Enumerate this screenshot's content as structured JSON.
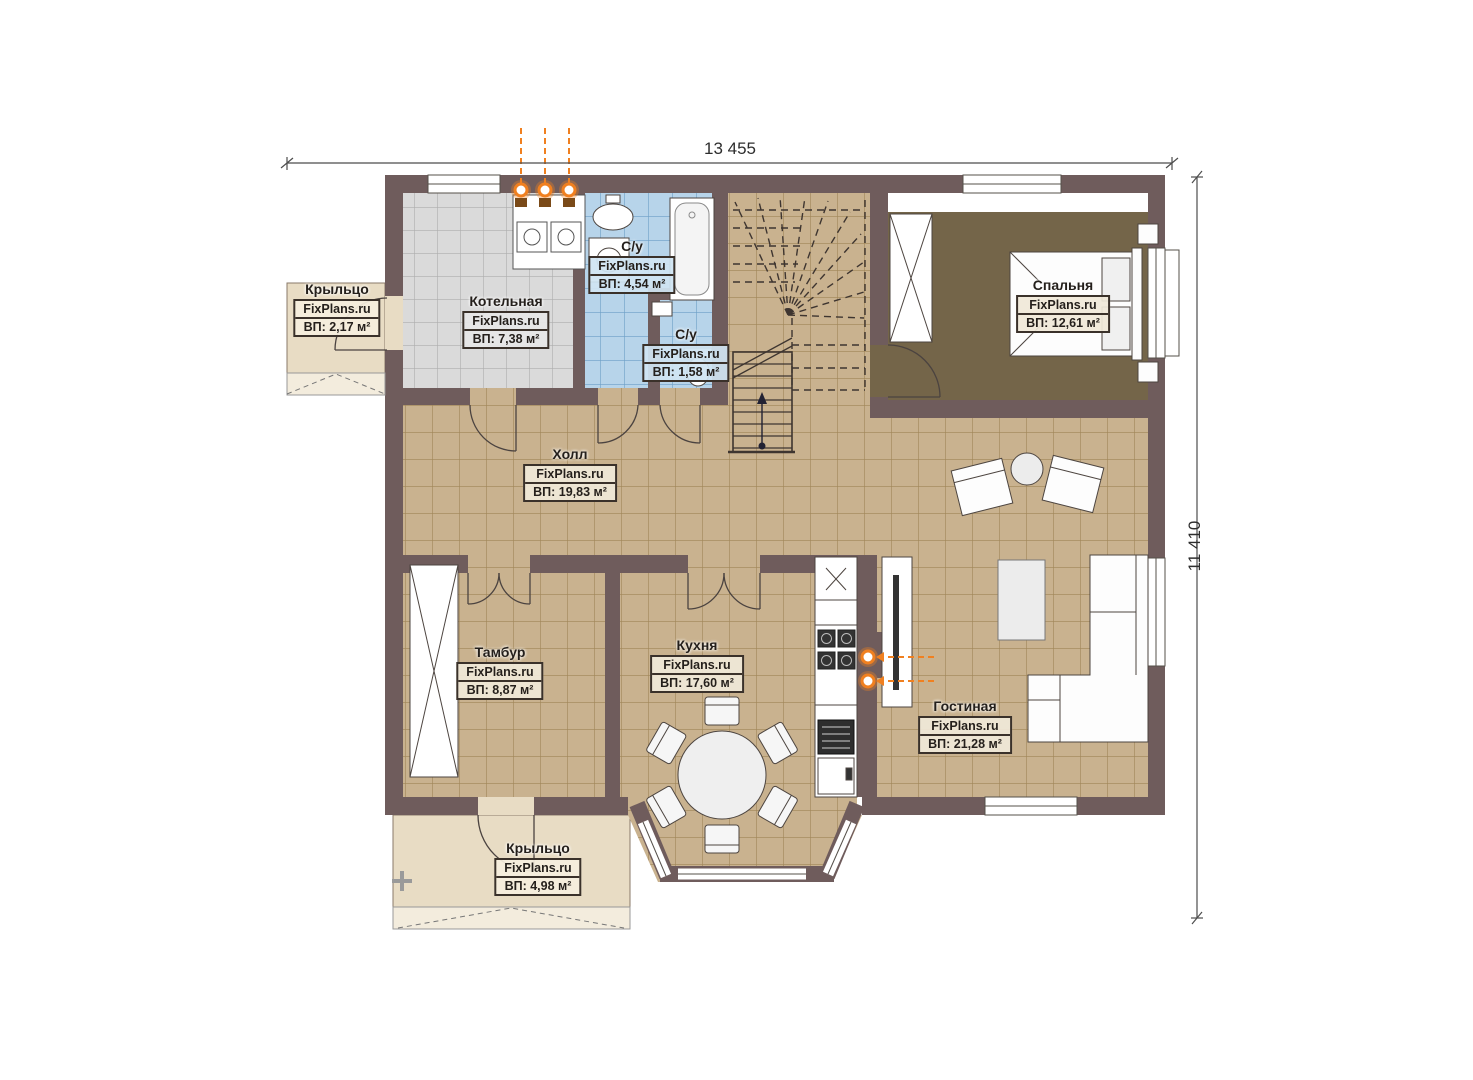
{
  "dimensions": {
    "width_label": "13 455",
    "height_label": "11 410"
  },
  "watermark": "FixPlans.ru",
  "rooms": [
    {
      "id": "porch-left",
      "name": "Крыльцо",
      "area": "ВП: 2,17 м²"
    },
    {
      "id": "boiler-room",
      "name": "Котельная",
      "area": "ВП: 7,38 м²"
    },
    {
      "id": "bathroom",
      "name": "С/у",
      "area": "ВП: 4,54 м²"
    },
    {
      "id": "wc",
      "name": "С/у",
      "area": "ВП: 1,58 м²"
    },
    {
      "id": "bedroom",
      "name": "Спальня",
      "area": "ВП: 12,61 м²"
    },
    {
      "id": "hall",
      "name": "Холл",
      "area": "ВП: 19,83 м²"
    },
    {
      "id": "vestibule",
      "name": "Тамбур",
      "area": "ВП: 8,87 м²"
    },
    {
      "id": "kitchen",
      "name": "Кухня",
      "area": "ВП: 17,60 м²"
    },
    {
      "id": "living-room",
      "name": "Гостиная",
      "area": "ВП: 21,28 м²"
    },
    {
      "id": "porch-bottom",
      "name": "Крыльцо",
      "area": "ВП: 4,98 м²"
    }
  ],
  "colors": {
    "wall": "#6f5c5c",
    "floor_tan": "#c9b28f",
    "floor_blue": "#b7d4ea",
    "floor_gray": "#dadada",
    "floor_bedroom": "#746549",
    "floor_porch": "#e8dcc4",
    "utility_accent": "#f08020"
  }
}
